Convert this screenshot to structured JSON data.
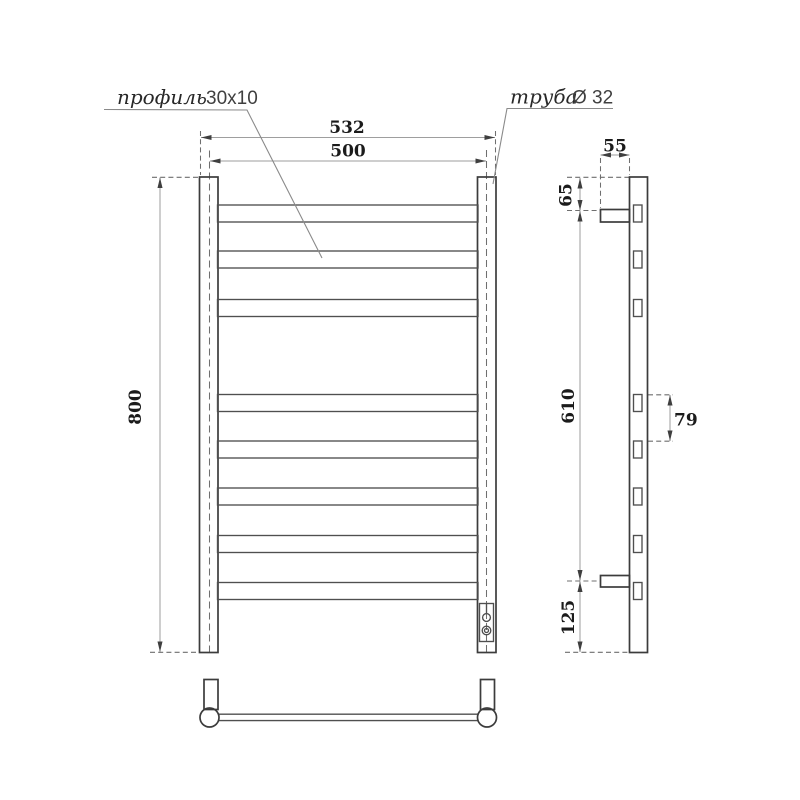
{
  "drawing": {
    "title_type": "towel-rail-technical-drawing",
    "labels": {
      "profile_word": "профиль",
      "profile_value": "30x10",
      "pipe_word": "труба",
      "pipe_value": "Ø 32"
    },
    "dimensions": {
      "overall_width": "532",
      "rail_width": "500",
      "overall_height": "800",
      "bracket_depth": "55",
      "top_offset": "65",
      "bracket_span": "610",
      "rung_spacing": "79",
      "bottom_offset": "125"
    },
    "colors": {
      "outline": "#3c3c3c",
      "rung_line": "#4f4f4f",
      "dimension_line": "#9e9e9e",
      "dashed_line": "#6f6f6f",
      "text": "#1b1b1b",
      "background": "#ffffff"
    }
  }
}
